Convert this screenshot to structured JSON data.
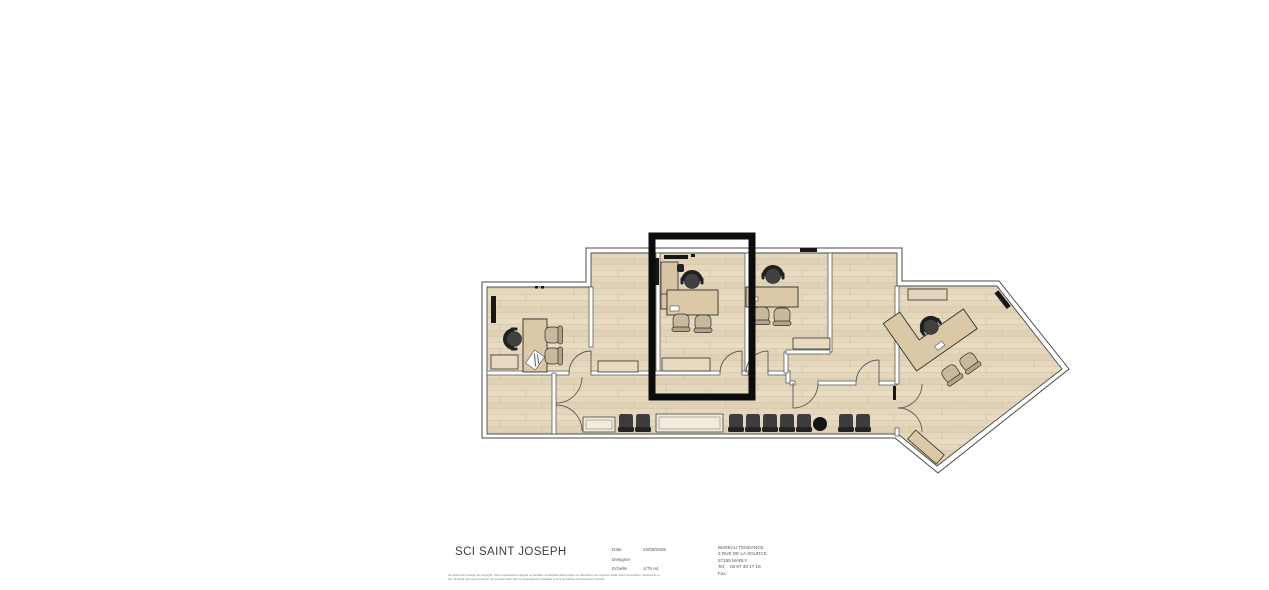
{
  "title_block": {
    "project_title": "SCI SAINT JOSEPH",
    "fields": [
      {
        "label": "Date",
        "value": "22/09/2025"
      },
      {
        "label": "Designer",
        "value": ""
      },
      {
        "label": "Echelle",
        "value": "1/75 A4"
      }
    ],
    "company": {
      "name": "BUREAU TENDANCE",
      "address1": "2 RUE DE LA SOURCE",
      "address2": "57155 MARLY",
      "tel_label": "Tel:",
      "tel_value": "03 87 30 17 18",
      "fax_label": "Fax:"
    },
    "copyright": {
      "line1": "Ce dessin est protégé par copyright. Toute reproduction intégrale ou partielle, modification électronique ou distribution de n'importe quelle façon (impression, photocopie ou",
      "line2": "par n'importe quel autre procédé) de ce dessin faite sans le consentement préalable et écrit de l'auteur est strictement interdite."
    }
  },
  "floor_plan": {
    "highlight_color": "#0c0c0c",
    "floor_color": "#e5d7bd",
    "plank_line_color": "#d2c2a4",
    "wall_fill": "#ffffff",
    "wall_outline": "#4a4a4a",
    "desk_color": "#dbc8a6",
    "cabinet_color": "#e7dac0",
    "office_chair_color": "#3d3d3d",
    "guest_chair_color": "#c7b99c",
    "waiting_chair_count": 9,
    "desk_count": 4
  }
}
